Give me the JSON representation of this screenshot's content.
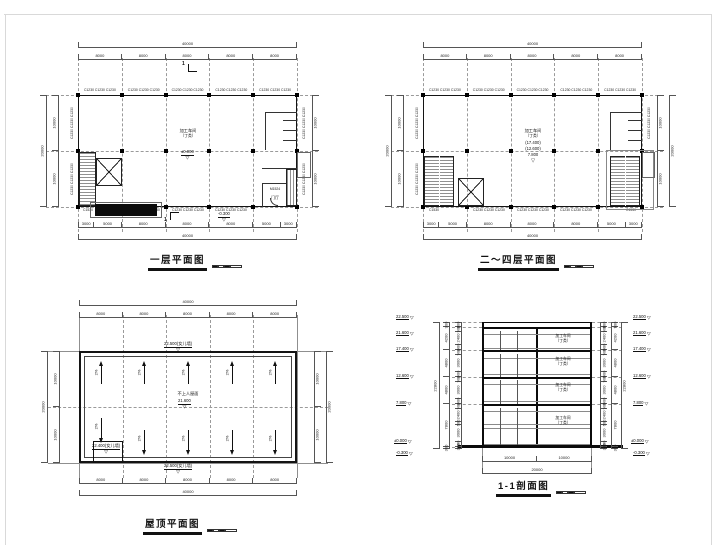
{
  "titles": {
    "plan1": "一层平面图",
    "plan2": "二～四层平面图",
    "roof": "屋顶平面图",
    "section": "1-1剖面图"
  },
  "labels": {
    "window_triplet": "C1230 C1230 C1230",
    "window_c1230": "C1230",
    "window_c1530": "C1530",
    "room_name": "加工车间",
    "room_class": "（丁类）",
    "door": "M1524",
    "lobby": "门厅",
    "roof_surface": "不上人屋面",
    "slope": "2%",
    "section_no": "1"
  },
  "levels": {
    "ground": "±0.000",
    "entry": "-0.300",
    "plan2": [
      "(17.400)",
      "(12.600)",
      "7.800"
    ],
    "roof_parapet": "22.500(女儿墙)",
    "roof_level": "21.600",
    "roof_bulkhead": "22.400(女儿墙)"
  },
  "dims": {
    "total_w": "40000",
    "bay": "8000",
    "half_h": "10000",
    "total_h": "20000",
    "end3": "3000",
    "end5": "5000",
    "sec_half": "10000",
    "sec_total": "20000",
    "sec_overall": "22800"
  },
  "section": {
    "levels": [
      "22.500",
      "21.600",
      "17.400",
      "12.600",
      "7.800",
      "±0.000",
      "-0.300"
    ],
    "floors": [
      "900",
      "4200",
      "4800",
      "4800",
      "7800",
      "300"
    ],
    "fine": [
      "900",
      "900",
      "2400",
      "900",
      "900",
      "3000",
      "900",
      "900",
      "3000",
      "900",
      "900",
      "2400",
      "600",
      "3000",
      "900",
      "300"
    ]
  }
}
